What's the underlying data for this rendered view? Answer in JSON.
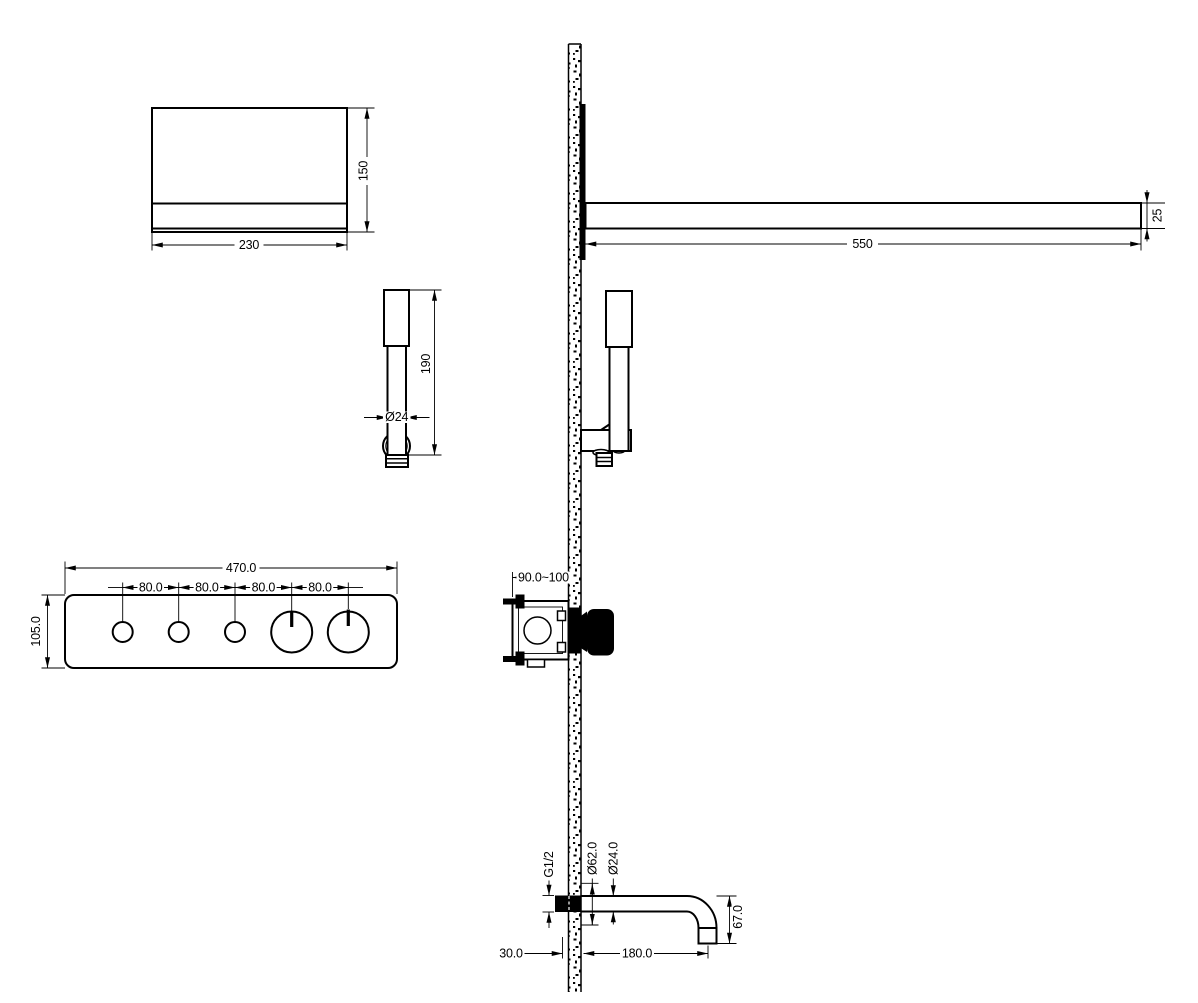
{
  "colors": {
    "line": "#000000",
    "background": "#ffffff"
  },
  "views": {
    "shower_head_front": {
      "width": "230",
      "height": "150"
    },
    "shower_arm_side": {
      "length": "550",
      "thickness": "25"
    },
    "hand_shower_front": {
      "length": "190",
      "diameter": "Ø24"
    },
    "control_panel_front": {
      "width": "470.0",
      "height": "105.0",
      "spacing": [
        "80.0",
        "80.0",
        "80.0",
        "80.0"
      ]
    },
    "concealed_valve_side": {
      "embed_depth": "90.0~100"
    },
    "spout_side": {
      "thread": "G1/2",
      "flange_diameter": "Ø62.0",
      "pipe_diameter": "Ø24.0",
      "wall_inset": "30.0",
      "reach": "180.0",
      "drop_height": "67.0"
    }
  }
}
